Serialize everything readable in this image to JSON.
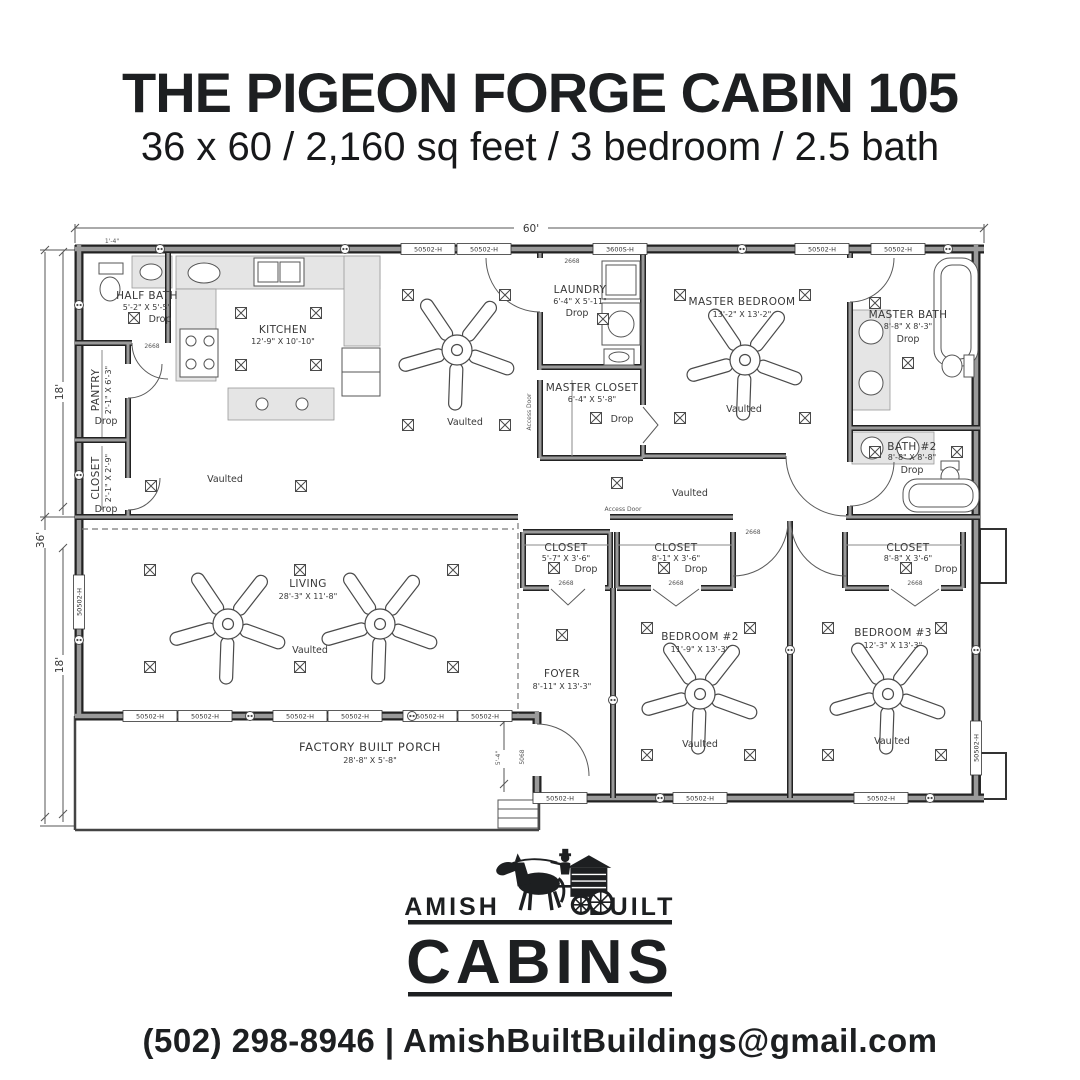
{
  "header": {
    "title": "THE PIGEON FORGE CABIN 105",
    "subtitle": "36 x 60 / 2,160 sq feet / 3 bedroom / 2.5 bath"
  },
  "plan": {
    "dims": {
      "width": "60'",
      "depth": "36'",
      "module_upper": "18'",
      "module_lower": "18'",
      "corner_offset": "1'-4\"",
      "porch_door": "5'-4\""
    },
    "labels": {
      "vaulted": "Vaulted",
      "drop": "Drop",
      "access_door": "Access Door",
      "window": "50502-H",
      "kitchen_window": "3600S-H",
      "door": "2668",
      "front_door": "5068"
    },
    "rooms": [
      {
        "name": "HALF BATH",
        "dims": "5'-2\" X 5'-5\"",
        "note": "Drop"
      },
      {
        "name": "PANTRY",
        "dims": "2'-1\" X 6'-3\"",
        "note": "Drop"
      },
      {
        "name": "CLOSET",
        "dims": "2'-1\" X 2'-9\"",
        "note": "Drop"
      },
      {
        "name": "KITCHEN",
        "dims": "12'-9\" X 10'-10\"",
        "note": ""
      },
      {
        "name": "LAUNDRY",
        "dims": "6'-4\" X 5'-11\"",
        "note": "Drop"
      },
      {
        "name": "MASTER CLOSET",
        "dims": "6'-4\" X 5'-8\"",
        "note": "Drop"
      },
      {
        "name": "MASTER BEDROOM",
        "dims": "13'-2\" X 13'-2\"",
        "note": "Vaulted"
      },
      {
        "name": "MASTER BATH",
        "dims": "8'-8\" X 8'-3\"",
        "note": "Drop"
      },
      {
        "name": "BATH #2",
        "dims": "8'-8\" X 8'-8\"",
        "note": "Drop"
      },
      {
        "name": "LIVING",
        "dims": "28'-3\" X 11'-8\"",
        "note": "Vaulted"
      },
      {
        "name": "FOYER",
        "dims": "8'-11\" X 13'-3\"",
        "note": ""
      },
      {
        "name": "CLOSET",
        "dims": "5'-7\" X 3'-6\"",
        "note": "Drop"
      },
      {
        "name": "CLOSET",
        "dims": "8'-1\" X 3'-6\"",
        "note": "Drop"
      },
      {
        "name": "BEDROOM #2",
        "dims": "11'-9\" X 13'-3\"",
        "note": "Vaulted"
      },
      {
        "name": "CLOSET",
        "dims": "8'-8\" X 3'-6\"",
        "note": "Drop"
      },
      {
        "name": "BEDROOM #3",
        "dims": "12'-3\" X 13'-3\"",
        "note": "Vaulted"
      },
      {
        "name": "FACTORY BUILT PORCH",
        "dims": "28'-8\" X 5'-8\"",
        "note": ""
      }
    ]
  },
  "logo": {
    "left": "AMISH",
    "right": "BUILT",
    "name": "CABINS"
  },
  "footer": {
    "contact": "(502) 298-8946 | AmishBuiltBuildings@gmail.com"
  }
}
